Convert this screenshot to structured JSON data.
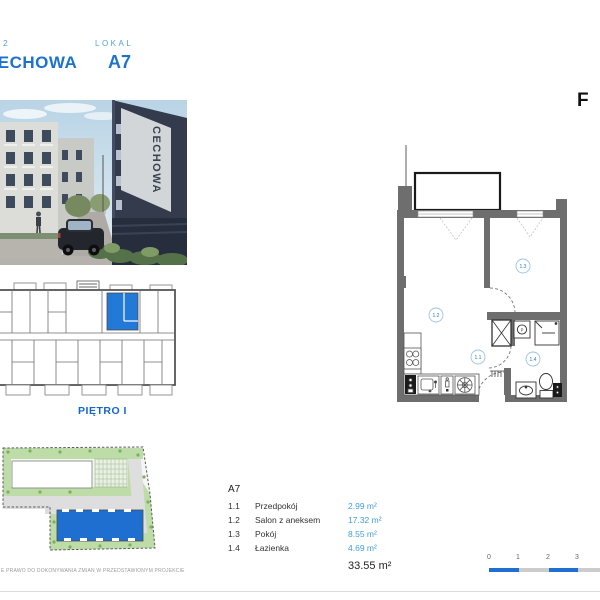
{
  "header": {
    "stage_number": "2",
    "project_name": "CECHOWA",
    "unit_label": "LOKAL",
    "unit_number": "A7"
  },
  "brand_letter": "F",
  "photo": {
    "sign_text": "CECHOWA"
  },
  "strip_plan": {
    "floor_label": "PIĘTRO I"
  },
  "unit_plan": {
    "rooms": {
      "hall": "1.1",
      "living": "1.2",
      "bedroom": "1.3",
      "bath": "1.4"
    }
  },
  "legend": {
    "unit": "A7",
    "rooms": [
      {
        "no": "1.1",
        "name": "Przedpokój",
        "area": "2.99 m²"
      },
      {
        "no": "1.2",
        "name": "Salon z aneksem",
        "area": "17.32 m²"
      },
      {
        "no": "1.3",
        "name": "Pokój",
        "area": "8.55 m²"
      },
      {
        "no": "1.4",
        "name": "Łazienka",
        "area": "4.69 m²"
      }
    ],
    "total": "33.55 m²"
  },
  "scale_bar": {
    "ticks": [
      "0",
      "1",
      "2",
      "3"
    ]
  },
  "disclaimer": "E PRAWO DO DOKONYWANIA ZMIAN W PRZEDSTAWIONYM PROJEKCIE",
  "colors": {
    "accent_blue": "#1b72cf",
    "muted_blue": "#55a0dc",
    "area_blue": "#3f9fdd",
    "highlight_blue": "#2176d2",
    "scale_blue": "#1f6fd0",
    "wall_gray": "#6e6e6e"
  }
}
